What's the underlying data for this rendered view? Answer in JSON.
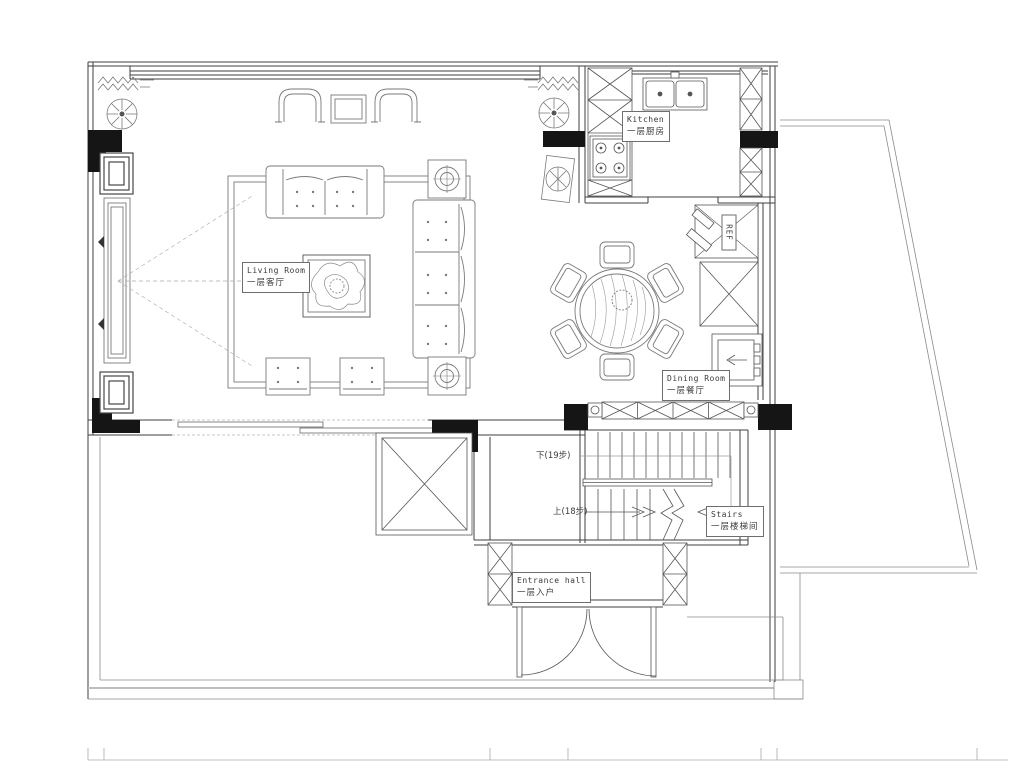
{
  "labels": {
    "living": {
      "en": "Living Room",
      "zh": "一层客厅"
    },
    "kitchen": {
      "en": "Kitchen",
      "zh": "一层厨房"
    },
    "dining": {
      "en": "Dining Room",
      "zh": "一层餐厅"
    },
    "stairs": {
      "en": "Stairs",
      "zh": "一层楼梯间"
    },
    "entrance": {
      "en": "Entrance hall",
      "zh": "一层入户"
    },
    "stair_down": "下(19步)",
    "stair_up": "上(18步)",
    "refrigerator": "REF"
  },
  "colors": {
    "background": "#ffffff",
    "wall_line": "#3f3f3f",
    "furniture_line": "#7a7a7a",
    "solid_wall_fill": "#151515"
  }
}
